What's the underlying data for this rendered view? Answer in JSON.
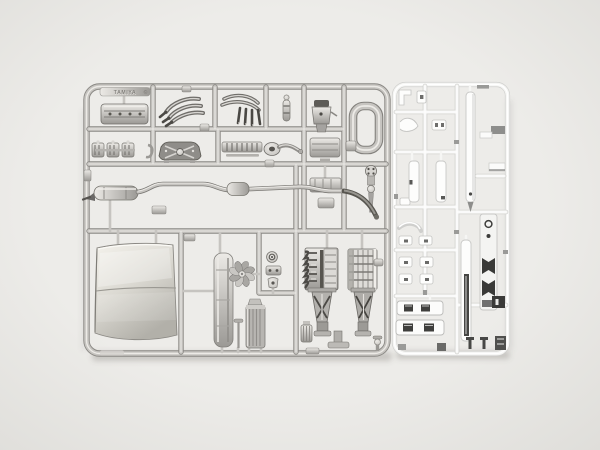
{
  "photo": {
    "logo_text": "TAMIYA",
    "logo_mark": "©"
  },
  "palette": {
    "background_hi": "#edece9",
    "background_lo": "#deddd9",
    "silver_hi": "#eceae6",
    "silver_mid": "#c6c4c0",
    "silver_lo": "#9b9995",
    "silver_edge": "#8a8884",
    "silver_deep": "#55534f",
    "chrome_hi": "#ffffff",
    "chrome_mid": "#f6f6f4",
    "chrome_edge": "#cfcfcd",
    "dark_accent": "#3c3c3a",
    "hood_hi": "#f4f2ec",
    "hood_mid": "#dcdad3",
    "hood_lo": "#b2b0a9",
    "shadow": "rgba(105,100,95,0.28)"
  }
}
